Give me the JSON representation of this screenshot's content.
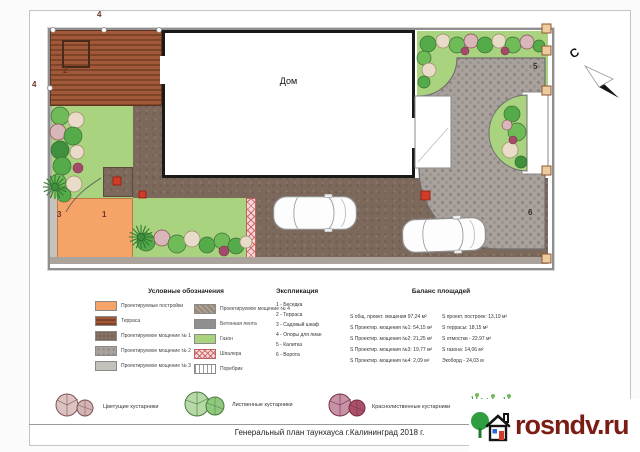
{
  "plan": {
    "house_label": "Дом",
    "north_label": "С",
    "labels": {
      "n1": "1",
      "n2": "2",
      "n3": "3",
      "n4_top": "4",
      "n4_left": "4",
      "n5": "5",
      "n6": "6"
    }
  },
  "legend": {
    "title": "Условные обозначения",
    "items": [
      {
        "label": "Проектируемые постройки"
      },
      {
        "label": "Терраса"
      },
      {
        "label": "Проектируемое мощение № 1"
      },
      {
        "label": "Проектируемое мощение № 2"
      },
      {
        "label": "Проектируемое мощение № 3"
      },
      {
        "label": "Проектируемое мощение № 4"
      },
      {
        "label": "Бетонная лента"
      },
      {
        "label": "Газон"
      },
      {
        "label": "Шпалера"
      },
      {
        "label": "Поребрик"
      }
    ]
  },
  "explication": {
    "title": "Экспликация",
    "items": [
      "1 - Беседка",
      "2 - Терраса",
      "3 - Садовый шкаф",
      "4 - Опоры для лиан",
      "5 - Калитка",
      "6 - Ворота"
    ]
  },
  "balance": {
    "title": "Баланс площадей",
    "left": [
      "S общ. проект. мощения 97,24 м²",
      "S Проектир. мощения №1: 54,15 м²",
      "S Проектир. мощения №2: 21,25 м²",
      "S Проектир. мощения №3: 19,77 м²",
      "S Проектир. мощения №4: 2,09 м²"
    ],
    "right": [
      "S проект. построек: 13,19 м²",
      "S террасы: 18,15 м²",
      "S отмостки - 22,97 м²",
      "S газона: 14,06 м²",
      "Экоборд - 24,03 м"
    ]
  },
  "shrub_legend": {
    "items": [
      "Цветущие кустарники",
      "Лиственные кустарники",
      "Краснолиственные кустарники"
    ]
  },
  "footer": {
    "title": "Генеральный план таунхауса г.Калининград 2018 г."
  },
  "watermark": {
    "text": "rosndv.ru"
  },
  "colors": {
    "lawn": "#a9d37e",
    "terrace": "#8f4e30",
    "paving_main": "#7c695c",
    "paving_grey": "#a8a19c",
    "building": "#f6a367",
    "trellis": "#cf6a6a",
    "marker_red": "#d23b28",
    "watermark_text": "#7b1d15",
    "shrub_green": "#55aa4a",
    "shrub_accent": "#a34b6b"
  }
}
